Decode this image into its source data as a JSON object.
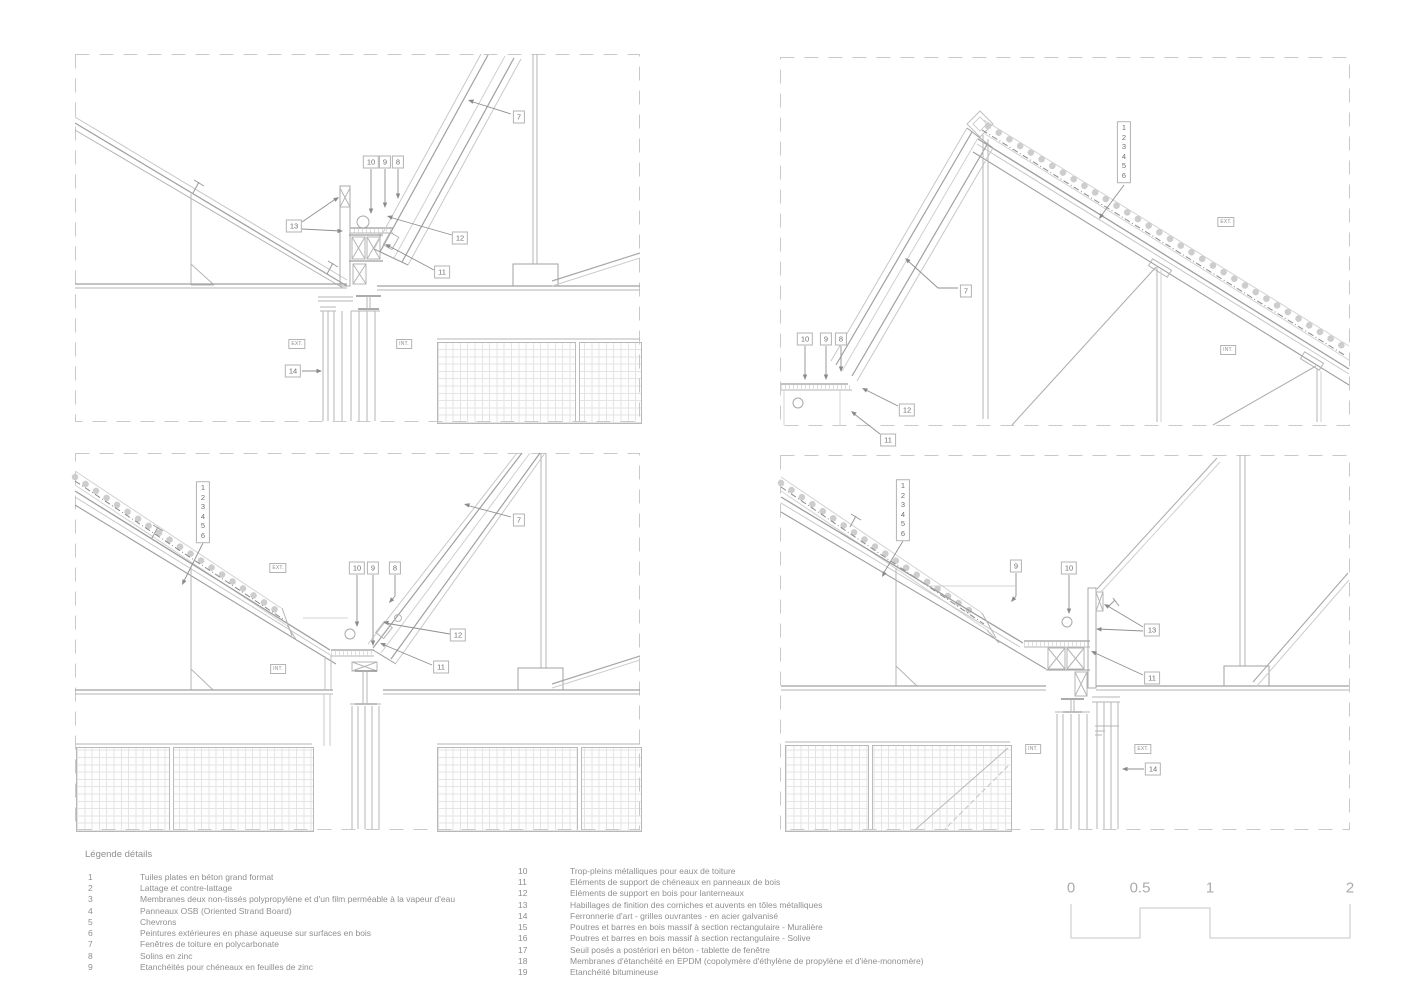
{
  "sheet": {
    "type": "architectural-detail-sheet",
    "colors": {
      "line_main": "#9e9e9e",
      "line_light": "#d2d2d2",
      "frame_dash": "#c9c9c9",
      "text": "#8f8f8f",
      "background": "#ffffff"
    }
  },
  "panels": {
    "top_left": {
      "callouts": {
        "n7": "7",
        "n8": "8",
        "n9": "9",
        "n10": "10",
        "n11": "11",
        "n12": "12",
        "n13": "13",
        "n14": "14"
      },
      "ext": "EXT.",
      "int": "INT."
    },
    "top_right": {
      "stack": [
        "1",
        "2",
        "3",
        "4",
        "5",
        "6"
      ],
      "callouts": {
        "n7": "7",
        "n8": "8",
        "n9": "9",
        "n10": "10",
        "n11": "11",
        "n12": "12"
      },
      "ext": "EXT.",
      "int": "INT."
    },
    "bottom_left": {
      "stack": [
        "1",
        "2",
        "3",
        "4",
        "5",
        "6"
      ],
      "callouts": {
        "n7": "7",
        "n8": "8",
        "n9": "9",
        "n10": "10",
        "n11": "11",
        "n12": "12"
      },
      "ext": "EXT.",
      "int": "INT."
    },
    "bottom_right": {
      "stack": [
        "1",
        "2",
        "3",
        "4",
        "5",
        "6"
      ],
      "callouts": {
        "n9": "9",
        "n10": "10",
        "n11": "11",
        "n13": "13",
        "n14": "14"
      },
      "ext": "EXT.",
      "int": "INT."
    }
  },
  "legend": {
    "title": "Légende détails",
    "items": [
      {
        "n": "1",
        "t": "Tuiles plates en béton grand format"
      },
      {
        "n": "2",
        "t": "Lattage et contre-lattage"
      },
      {
        "n": "3",
        "t": "Membranes deux non-tissés polypropylène et d'un film perméable à la vapeur d'eau"
      },
      {
        "n": "4",
        "t": "Panneaux OSB (Oriented Strand Board)"
      },
      {
        "n": "5",
        "t": "Chevrons"
      },
      {
        "n": "6",
        "t": "Peintures extérieures en phase aqueuse sur surfaces en bois"
      },
      {
        "n": "7",
        "t": "Fenêtres de toiture en polycarbonate"
      },
      {
        "n": "8",
        "t": "Solins en zinc"
      },
      {
        "n": "9",
        "t": "Etanchéités pour chéneaux en feuilles de zinc"
      },
      {
        "n": "10",
        "t": "Trop-pleins métalliques pour eaux de toiture"
      },
      {
        "n": "11",
        "t": "Eléments de support de chéneaux en panneaux de bois"
      },
      {
        "n": "12",
        "t": "Eléments de support en bois pour lanterneaux"
      },
      {
        "n": "13",
        "t": "Habillages de finition des corniches et auvents en tôles métalliques"
      },
      {
        "n": "14",
        "t": "Ferronnerie d'art - grilles ouvrantes - en acier galvanisé"
      },
      {
        "n": "15",
        "t": "Poutres et barres en bois massif à section rectangulaire - Muralière"
      },
      {
        "n": "16",
        "t": "Poutres et barres en bois massif à section rectangulaire - Solive"
      },
      {
        "n": "17",
        "t": "Seuil posés a postériori en béton - tablette de fenêtre"
      },
      {
        "n": "18",
        "t": "Membranes d'étanchéité en EPDM (copolymère d'éthylène de propylène et d'iène-monomère)"
      },
      {
        "n": "19",
        "t": "Etanchéité bitumineuse"
      }
    ]
  },
  "scale_bar": {
    "labels": [
      "0",
      "0.5",
      "1",
      "2"
    ]
  }
}
